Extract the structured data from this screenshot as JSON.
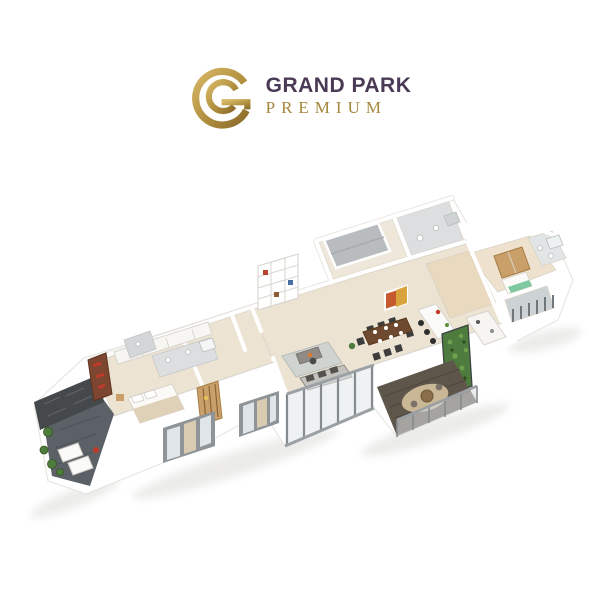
{
  "logo": {
    "name1": "GRAND PARK",
    "name2": "PREMIUM",
    "monogram_icon": "double-g-circle-monogram"
  },
  "palette": {
    "bg": "#ffffff",
    "brand-dark": "#4a3a55",
    "brand-gold": "#a5873b",
    "gold-light": "#d4b264",
    "gold-dark": "#8f6f2c",
    "wall": "#ffffff",
    "wall-shade": "#e9e7e2",
    "floor": "#ece3d3",
    "floor-wood": "#e8d9bf",
    "tile": "#dcdedf",
    "slate": "#5b6166",
    "stone": "#45494c",
    "deck": "#5f564b",
    "wood": "#8a5c35",
    "wood-light": "#c9a06a",
    "fabric": "#eceae5",
    "rug": "#d0d4d1",
    "rug-round": "#c9b795",
    "chair-dark": "#3d3d3d",
    "green": "#4e7c3f",
    "teal": "#7fc9a0",
    "accent-red": "#c03a2a",
    "accent-orange": "#d97c2e",
    "glass": "#dfe5e8",
    "frame": "#9aa0a4",
    "shadow": "#8a887f"
  }
}
